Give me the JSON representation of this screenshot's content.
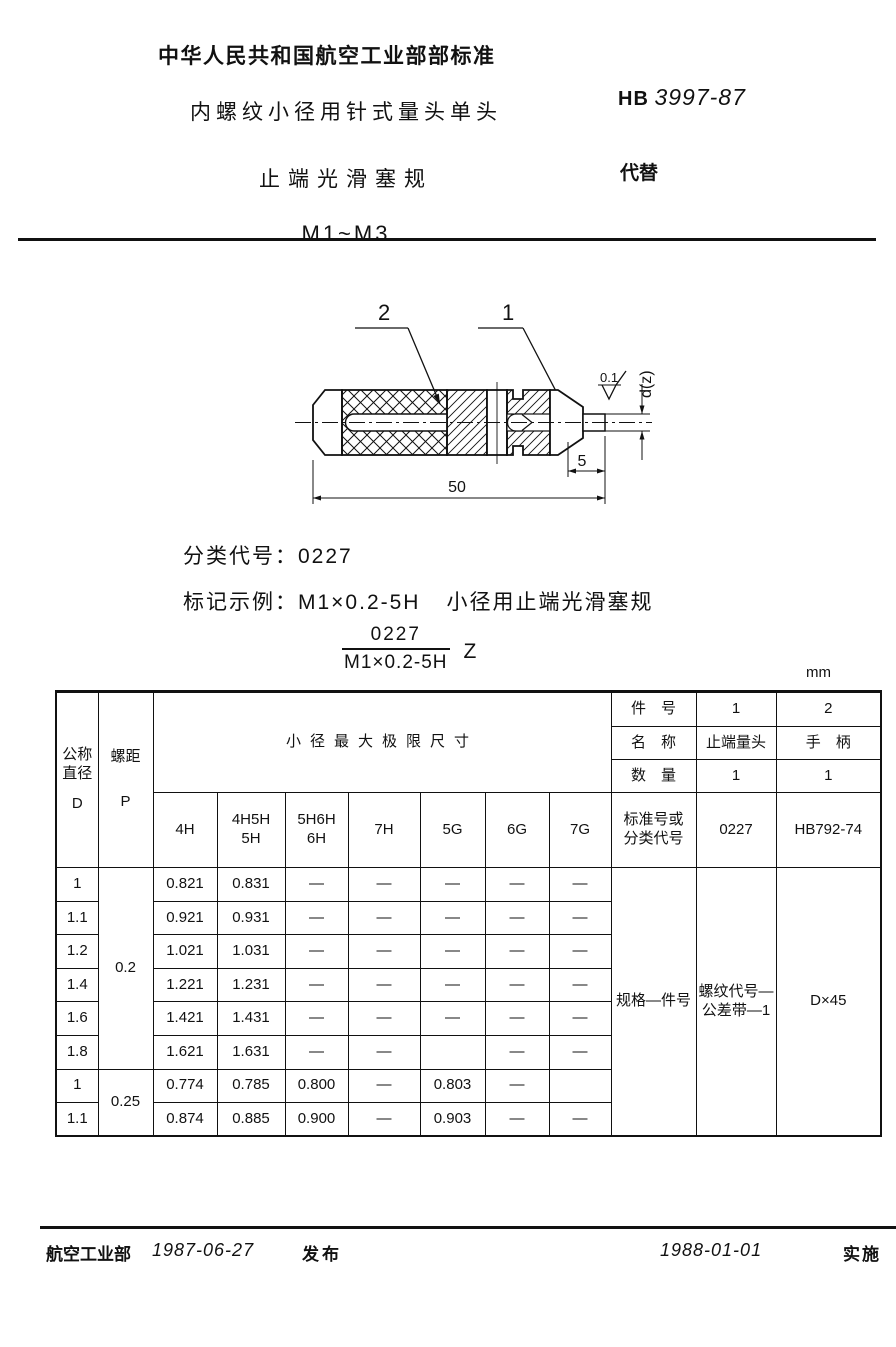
{
  "header": {
    "org_title": "中华人民共和国航空工业部部标准",
    "doc_title_line1": "内螺纹小径用针式量头单头",
    "doc_title_line2": "止端光滑塞规",
    "doc_title_line3": "M1~M3",
    "standard_prefix": "HB",
    "standard_number": "3997-87",
    "supersedes_label": "代替"
  },
  "drawing": {
    "part_label_1": "1",
    "part_label_2": "2",
    "dim_pin_length": "5",
    "dim_total_length": "50",
    "dim_diameter": "d(z)",
    "roughness_value": "0.1"
  },
  "classification": {
    "label": "分类代号：",
    "code": "0227"
  },
  "marking": {
    "label": "标记示例：",
    "example": "M1×0.2-5H",
    "description": "小径用止端光滑塞规",
    "fraction_numerator": "0227",
    "fraction_denominator": "M1×0.2-5H",
    "suffix": "Z"
  },
  "table": {
    "unit": "mm",
    "left": {
      "col_d_stacked": "公称\n直径",
      "col_d_symbol": "D",
      "col_p_label": "螺距",
      "col_p_symbol": "P",
      "span_header": "小径最大极限尺寸",
      "tol_cols": [
        "4H",
        "4H5H\n5H",
        "5H6H\n6H",
        "7H",
        "5G",
        "6G",
        "7G"
      ]
    },
    "right": {
      "part_no_label": "件　号",
      "part_nos": [
        "1",
        "2"
      ],
      "name_label": "名　称",
      "names": [
        "止端量头",
        "手　柄"
      ],
      "qty_label": "数　量",
      "qtys": [
        "1",
        "1"
      ],
      "std_label": "标准号或\n分类代号",
      "stds": [
        "0227",
        "HB792-74"
      ],
      "spec_label": "规格—件号",
      "spec_thread": "螺纹代号—\n公差带—1",
      "spec_size": "D×45"
    },
    "p_groups": [
      {
        "p": "0.2"
      },
      {
        "p": "0.25"
      }
    ],
    "rows": [
      {
        "d": "1",
        "vals": [
          "0.821",
          "0.831",
          "—",
          "—",
          "—",
          "—",
          "—"
        ]
      },
      {
        "d": "1.1",
        "vals": [
          "0.921",
          "0.931",
          "—",
          "—",
          "—",
          "—",
          "—"
        ]
      },
      {
        "d": "1.2",
        "vals": [
          "1.021",
          "1.031",
          "—",
          "—",
          "—",
          "—",
          "—"
        ]
      },
      {
        "d": "1.4",
        "vals": [
          "1.221",
          "1.231",
          "—",
          "—",
          "—",
          "—",
          "—"
        ]
      },
      {
        "d": "1.6",
        "vals": [
          "1.421",
          "1.431",
          "—",
          "—",
          "—",
          "—",
          "—"
        ]
      },
      {
        "d": "1.8",
        "vals": [
          "1.621",
          "1.631",
          "—",
          "—",
          "",
          "—",
          "—"
        ]
      },
      {
        "d": "1",
        "vals": [
          "0.774",
          "0.785",
          "0.800",
          "—",
          "0.803",
          "—",
          ""
        ]
      },
      {
        "d": "1.1",
        "vals": [
          "0.874",
          "0.885",
          "0.900",
          "—",
          "0.903",
          "—",
          "—"
        ]
      }
    ]
  },
  "footer": {
    "issuer": "航空工业部",
    "issue_date": "1987-06-27",
    "issue_label": "发布",
    "effective_date": "1988-01-01",
    "effective_label": "实施"
  }
}
